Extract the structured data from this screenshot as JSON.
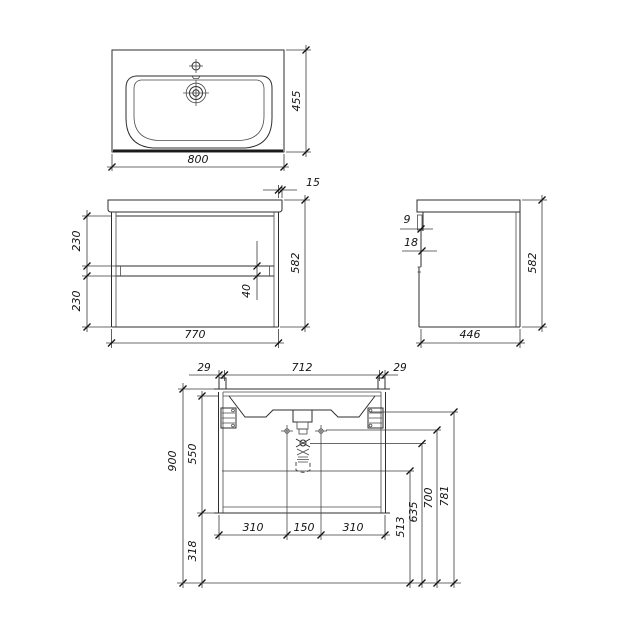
{
  "views": {
    "basin_top": {
      "width": "800",
      "depth": "455"
    },
    "cabinet_front": {
      "width": "770",
      "height": "582",
      "top_overhang": "15",
      "upper_drawer": "230",
      "lower_drawer": "230",
      "drawer_gap": "40"
    },
    "cabinet_side": {
      "depth": "446",
      "height": "582",
      "front_lip": "9",
      "front_step": "18"
    },
    "installation": {
      "hanger_left_offset": "29",
      "hanger_span": "712",
      "hanger_right_offset": "29",
      "mount_height": "900",
      "hanger_drop": "550",
      "floor_clearance": "318",
      "supply_left": "310",
      "supply_span": "150",
      "supply_right": "310",
      "outlet_height": "513",
      "trap_height": "635",
      "supply_height": "700",
      "drain_height": "781"
    }
  },
  "line_color": "#2e2e2e"
}
